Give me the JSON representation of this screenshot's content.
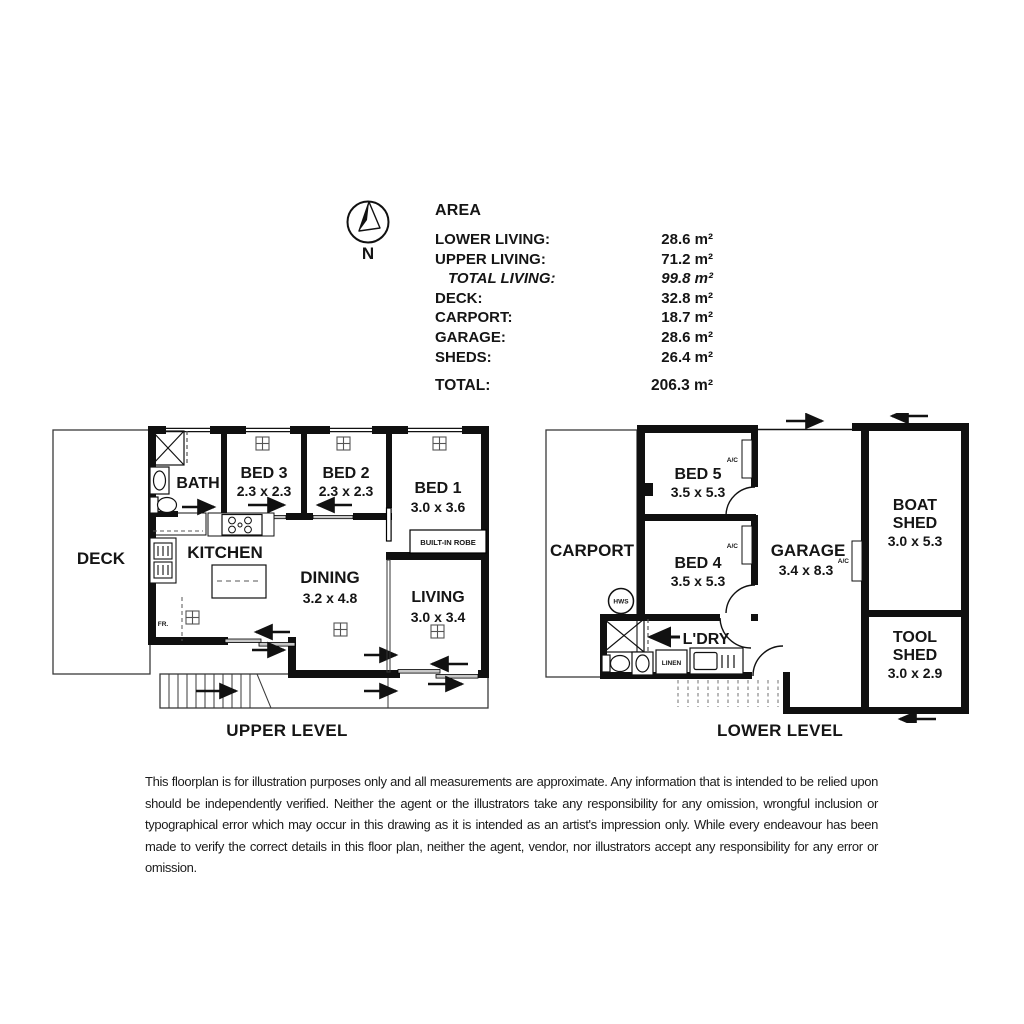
{
  "compass": {
    "label": "N"
  },
  "area_table": {
    "title": "AREA",
    "rows": [
      {
        "label": "LOWER LIVING:",
        "value": "28.6 m²"
      },
      {
        "label": "UPPER LIVING:",
        "value": "71.2 m²"
      },
      {
        "label": "TOTAL LIVING:",
        "value": "99.8 m²"
      },
      {
        "label": "DECK:",
        "value": "32.8 m²"
      },
      {
        "label": "CARPORT:",
        "value": "18.7 m²"
      },
      {
        "label": "GARAGE:",
        "value": "28.6 m²"
      },
      {
        "label": "SHEDS:",
        "value": "26.4 m²"
      }
    ],
    "total": {
      "label": "TOTAL:",
      "value": "206.3 m²"
    }
  },
  "upper_plan": {
    "title": "UPPER LEVEL",
    "rooms": {
      "deck": {
        "name": "DECK"
      },
      "bath": {
        "name": "BATH"
      },
      "bed3": {
        "name": "BED 3",
        "dims": "2.3 x 2.3"
      },
      "bed2": {
        "name": "BED 2",
        "dims": "2.3 x 2.3"
      },
      "bed1": {
        "name": "BED 1",
        "dims": "3.0 x 3.6"
      },
      "kitchen": {
        "name": "KITCHEN"
      },
      "dining": {
        "name": "DINING",
        "dims": "3.2 x 4.8"
      },
      "living": {
        "name": "LIVING",
        "dims": "3.0 x 3.4"
      }
    },
    "labels": {
      "built_in_robe": "BUILT-IN ROBE",
      "fridge": "FR."
    }
  },
  "lower_plan": {
    "title": "LOWER LEVEL",
    "rooms": {
      "carport": {
        "name": "CARPORT"
      },
      "bed5": {
        "name": "BED 5",
        "dims": "3.5 x 5.3"
      },
      "bed4": {
        "name": "BED 4",
        "dims": "3.5 x 5.3"
      },
      "garage": {
        "name": "GARAGE",
        "dims": "3.4 x 8.3"
      },
      "boat_shed": {
        "lines": [
          "BOAT",
          "SHED"
        ],
        "dims": "3.0 x 5.3"
      },
      "tool_shed": {
        "lines": [
          "TOOL",
          "SHED"
        ],
        "dims": "3.0 x 2.9"
      },
      "laundry": {
        "name": "L'DRY"
      }
    },
    "labels": {
      "linen": "LINEN",
      "hws": "HWS",
      "ac": "A/C"
    }
  },
  "disclaimer": "This floorplan is for illustration purposes only and all measurements are approximate. Any information that is intended to be relied upon should be independently verified. Neither the agent or the illustrators take any responsibility for any omission, wrongful inclusion or typographical error which may occur in this drawing as it is intended as an artist's impression only. While every endeavour has been made to verify the correct details in this floor plan, neither the agent, vendor, nor illustrators accept any responsibility for any error or omission."
}
